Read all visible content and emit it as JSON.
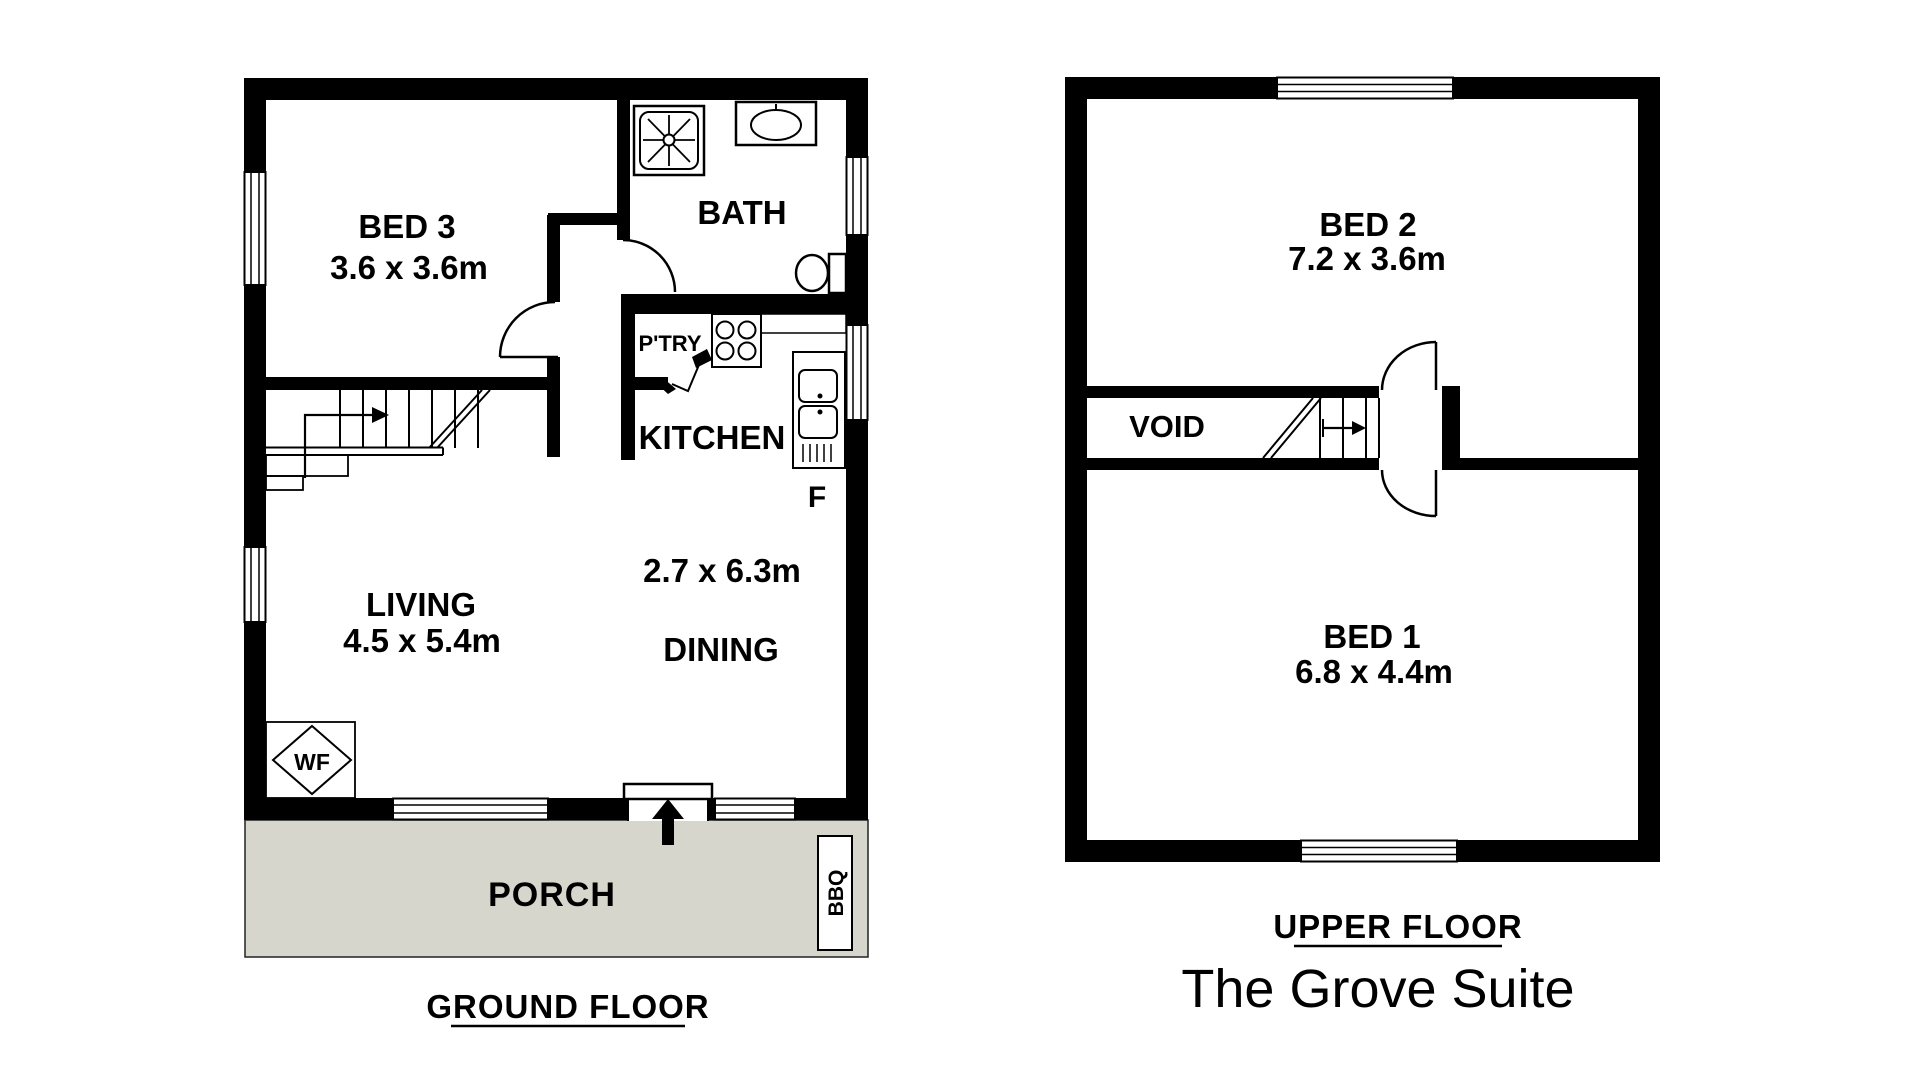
{
  "palette": {
    "ink": "#000000",
    "porch_fill": "#d6d6cd",
    "background": "#ffffff"
  },
  "ground_floor": {
    "section_label": "GROUND FLOOR",
    "bed3_name": "BED 3",
    "bed3_dims": "3.6 x 3.6m",
    "bath_name": "BATH",
    "pantry_name": "P'TRY",
    "kitchen_name": "KITCHEN",
    "fridge_label": "F",
    "dining_dims": "2.7 x 6.3m",
    "dining_name": "DINING",
    "living_name": "LIVING",
    "living_dims": "4.5 x 5.4m",
    "porch_name": "PORCH",
    "bbq_label": "BBQ",
    "wf_label": "WF"
  },
  "upper_floor": {
    "section_label": "UPPER FLOOR",
    "bed2_name": "BED 2",
    "bed2_dims": "7.2 x 3.6m",
    "void_name": "VOID",
    "bed1_name": "BED 1",
    "bed1_dims": "6.8 x 4.4m"
  },
  "plan_title": "The Grove Suite"
}
